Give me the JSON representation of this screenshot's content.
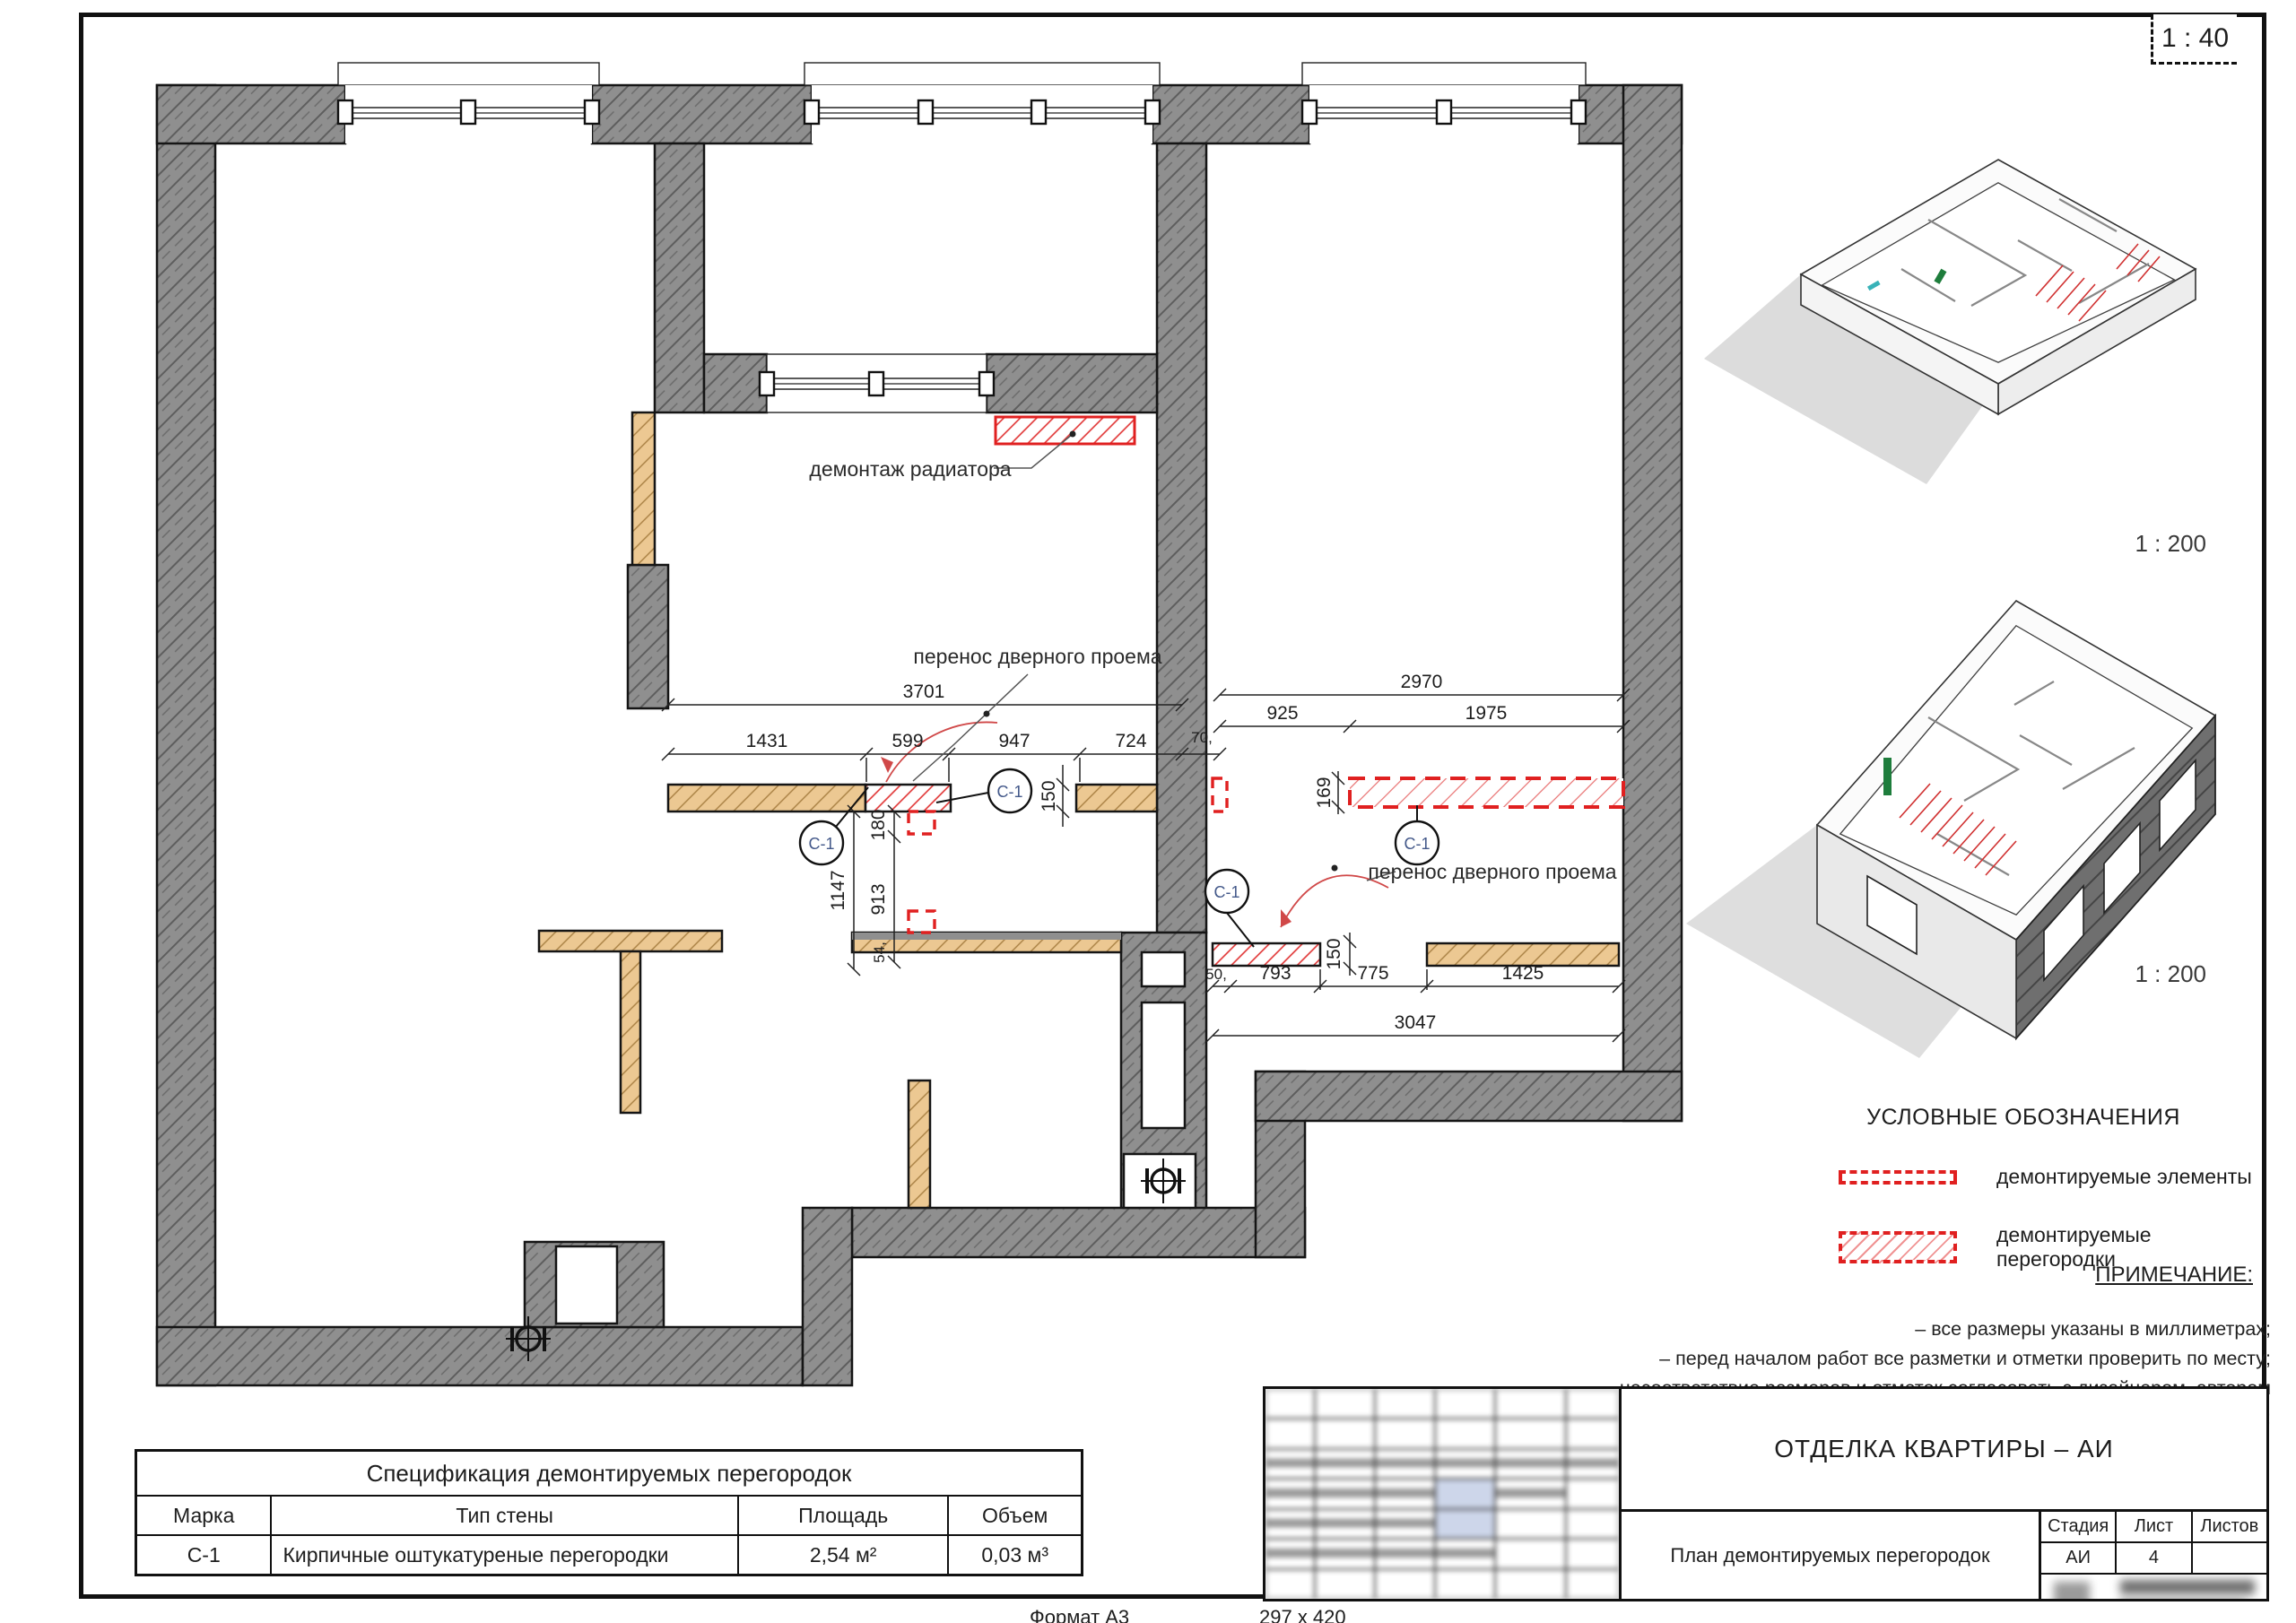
{
  "sheet": {
    "scale_badge": "1 : 40",
    "format_label": "Формат А3",
    "paper_size": "297 х 420"
  },
  "plan": {
    "annotations": {
      "radiator": "демонтаж радиатора",
      "door_move_left": "перенос дверного проема",
      "door_move_right": "перенос дверного проема"
    },
    "marker_c1": "С-1",
    "dims": {
      "d3701": "3701",
      "d1431": "1431",
      "d599": "599",
      "d947": "947",
      "d724": "724",
      "d70": "70,",
      "d2970": "2970",
      "d925": "925",
      "d1975": "1975",
      "d150a": "150",
      "d169": "169",
      "d180": "180",
      "d1147": "1147",
      "d913": "913",
      "d54": "54,",
      "d50": "50,",
      "d793": "793",
      "d775": "775",
      "d1425": "1425",
      "d3047": "3047",
      "d150b": "150"
    }
  },
  "axonometric": {
    "top_scale": "1 : 200",
    "bottom_scale": "1 : 200"
  },
  "legend": {
    "title": "УСЛОВНЫЕ ОБОЗНАЧЕНИЯ",
    "items": [
      {
        "label": "демонтируемые элементы"
      },
      {
        "label": "демонтируемые перегородки"
      }
    ],
    "note_title": "ПРИМЕЧАНИЕ:",
    "notes": [
      "– все размеры указаны в миллиметрах;",
      "– перед началом работ все разметки и отметки проверить по месту;",
      "– несоответствие размеров и отметок согласовать с дизайнером–автором проекта;"
    ]
  },
  "spec_table": {
    "title": "Спецификация демонтируемых перегородок",
    "col_mark": "Марка",
    "col_type": "Тип стены",
    "col_area": "Площадь",
    "col_volume": "Объем",
    "row_mark": "С-1",
    "row_type": "Кирпичные оштукатуреные перегородки",
    "row_area": "2,54 м²",
    "row_volume": "0,03 м³"
  },
  "title_block": {
    "project": "ОТДЕЛКА КВАРТИРЫ – АИ",
    "drawing_title": "План демонтируемых перегородок",
    "stage_label": "Стадия",
    "sheet_label": "Лист",
    "sheets_label": "Листов",
    "stage": "АИ",
    "sheet_no": "4",
    "sheets_total": ""
  }
}
